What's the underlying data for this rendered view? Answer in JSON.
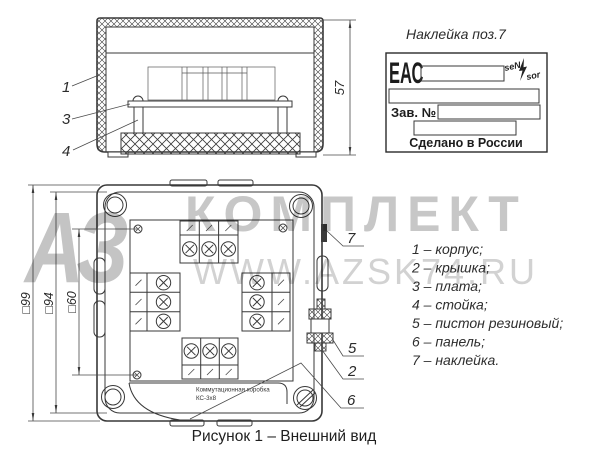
{
  "caption": {
    "text": "Рисунок 1 – Внешний вид"
  },
  "watermark": {
    "logo": "АЗ",
    "brand": "КОМПЛЕКТ",
    "site": "WWW.AZSK74.RU"
  },
  "side_view": {
    "dim_height": "57",
    "callouts": [
      "1",
      "3",
      "4"
    ]
  },
  "label_sticker": {
    "title": "Наклейка поз.7",
    "eac": "ЕАС",
    "brand_left": "seN",
    "brand_right": "sor",
    "serial_label": "Зав. №",
    "made_in": "Сделано в России"
  },
  "top_view": {
    "dims": [
      "□99",
      "□94",
      "□60"
    ],
    "callouts": [
      "7",
      "5",
      "2",
      "6"
    ],
    "nameplate_line1": "Коммутационная коробка",
    "nameplate_line2": "КС-3х8"
  },
  "parts_list": {
    "items": [
      "1 – корпус;",
      "2 – крышка;",
      "3 – плата;",
      "4 – стойка;",
      "5 – пистон резиновый;",
      "6 – панель;",
      "7 – наклейка."
    ]
  },
  "colors": {
    "line": "#383838",
    "watermark_brand": "#c7c7c7",
    "watermark_site": "#d2d2d2",
    "background": "#ffffff"
  }
}
